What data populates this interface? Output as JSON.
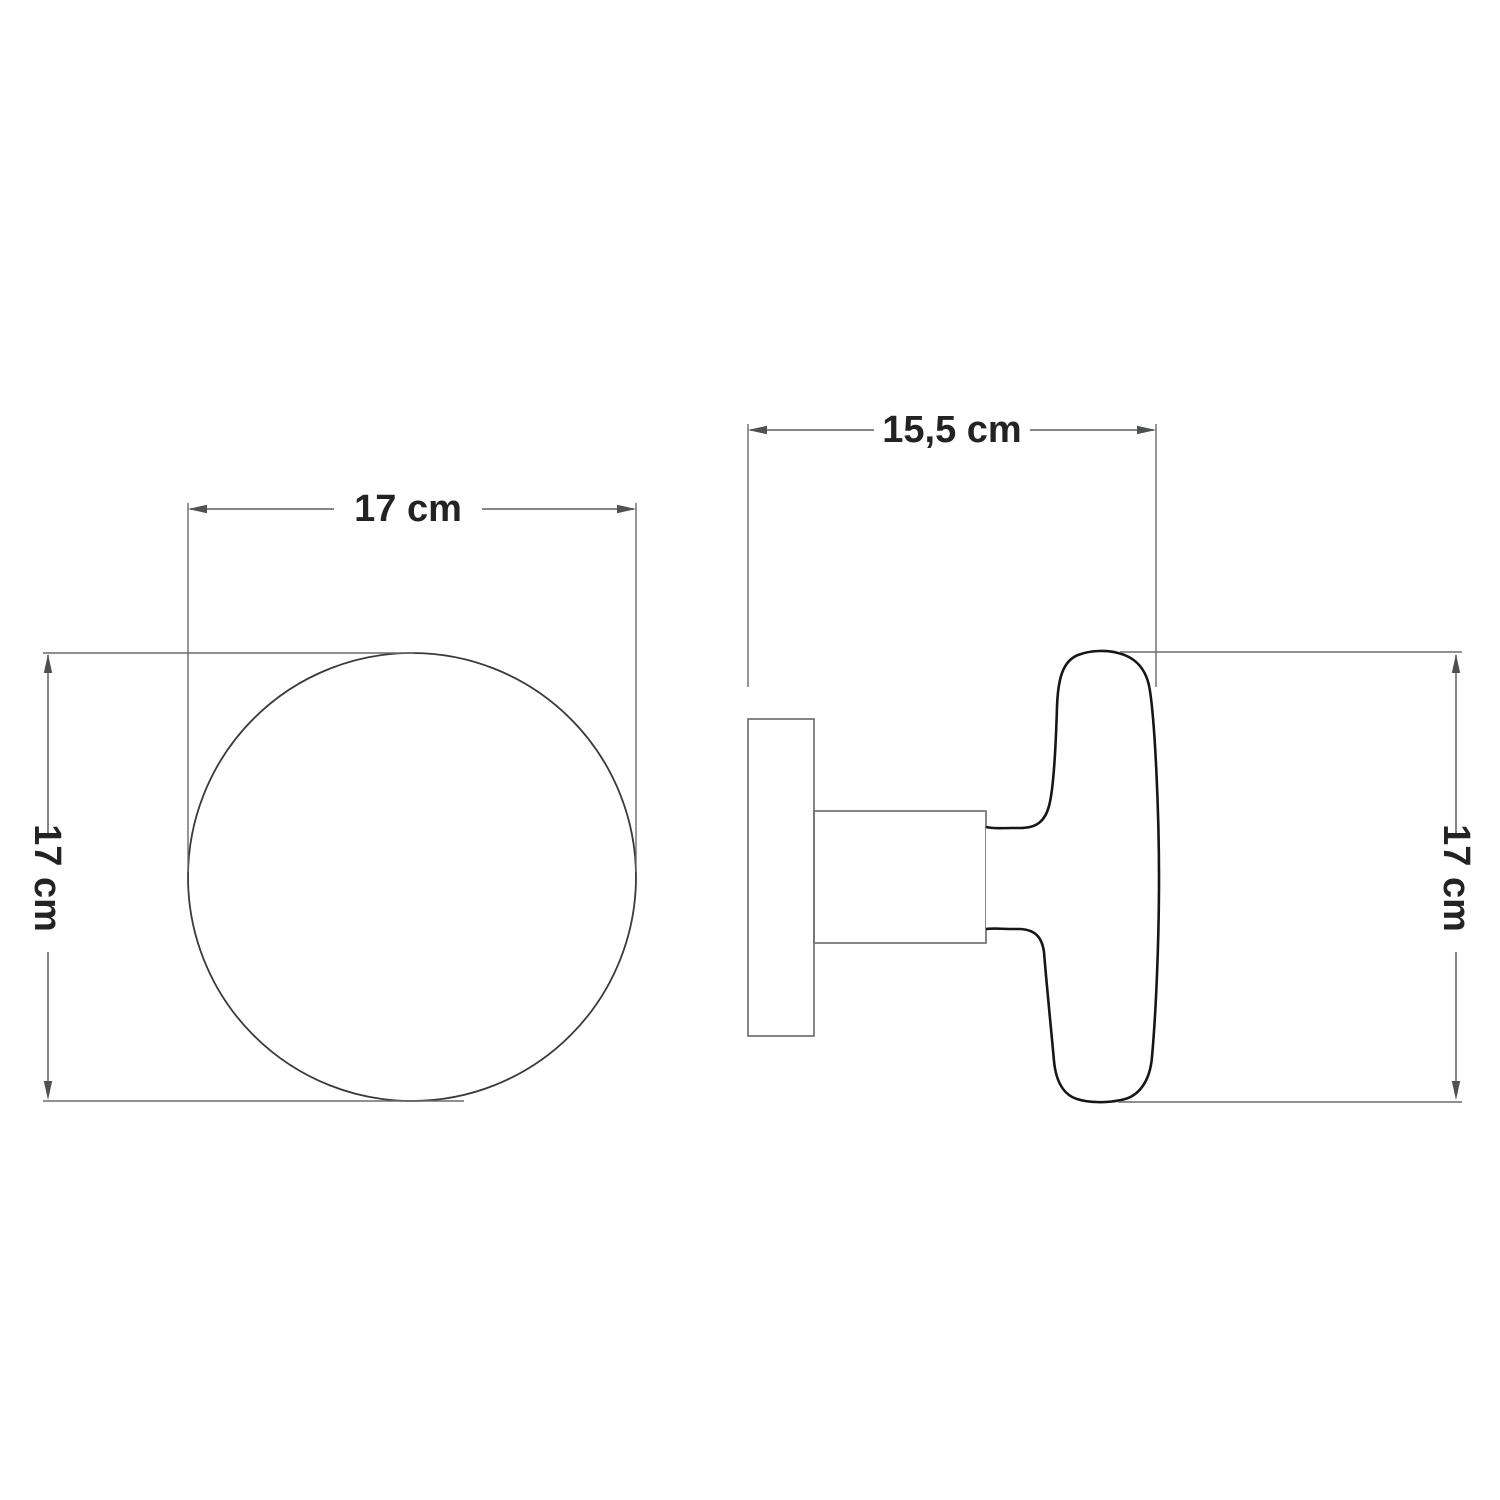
{
  "front_view": {
    "width_label": "17 cm",
    "height_label": "17 cm"
  },
  "side_view": {
    "depth_label": "15,5 cm",
    "height_label": "17 cm"
  },
  "colors": {
    "background": "#ffffff",
    "dimension_line": "#5d5e60",
    "drawing_outline": "#161616",
    "secondary_outline": "#6f7072",
    "label_text": "#232323"
  }
}
